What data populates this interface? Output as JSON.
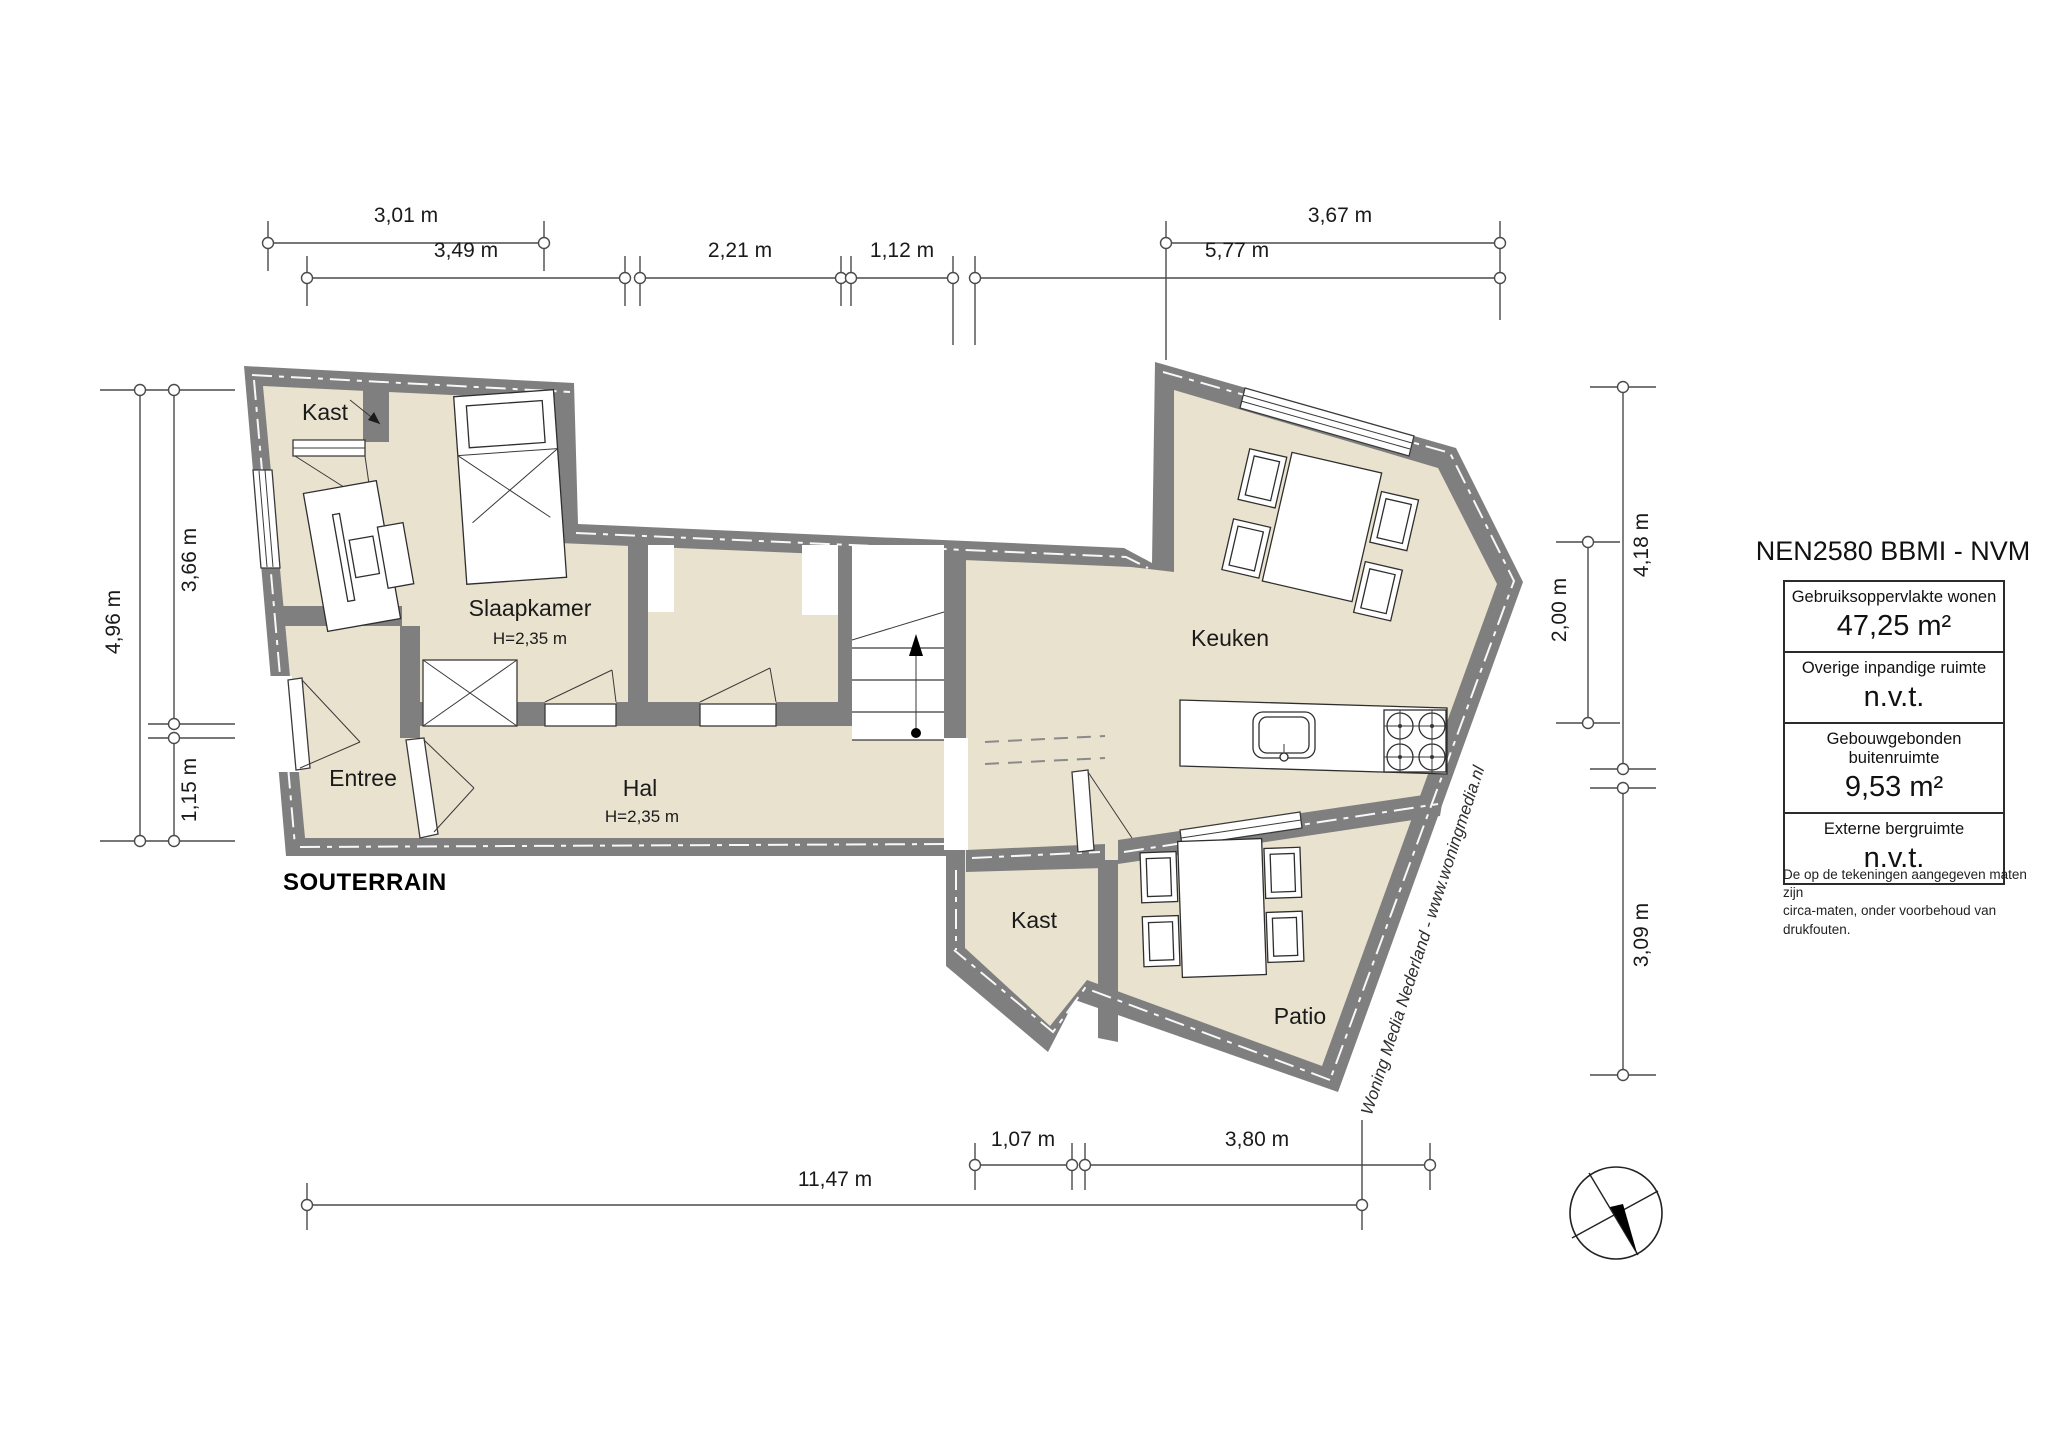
{
  "colors": {
    "wall": "#7f7f7f",
    "floor": "#e9e2cf",
    "ink": "#1a1a1a",
    "dim": "#4a4a4a",
    "paper": "#ffffff"
  },
  "floor_label": "SOUTERRAIN",
  "rooms": {
    "kast_top": {
      "label": "Kast"
    },
    "slaapkamer": {
      "label": "Slaapkamer",
      "height": "H=2,35 m"
    },
    "entree": {
      "label": "Entree"
    },
    "hal": {
      "label": "Hal",
      "height": "H=2,35 m"
    },
    "keuken": {
      "label": "Keuken"
    },
    "kast_bottom": {
      "label": "Kast"
    },
    "patio": {
      "label": "Patio"
    }
  },
  "dimensions": {
    "top_row1": [
      "3,01 m",
      "3,67 m"
    ],
    "top_row2": [
      "3,49 m",
      "2,21 m",
      "1,12 m",
      "5,77 m"
    ],
    "left": [
      "4,96 m",
      "3,66 m",
      "1,15 m"
    ],
    "right": [
      "4,18 m",
      "2,00 m",
      "3,09 m"
    ],
    "bottom_row1": [
      "1,07 m",
      "3,80 m"
    ],
    "bottom_row2": [
      "11,47 m"
    ]
  },
  "legend_table": {
    "title": "NEN2580 BBMI - NVM",
    "rows": [
      {
        "label": "Gebruiksoppervlakte wonen",
        "value": "47,25 m²"
      },
      {
        "label": "Overige inpandige ruimte",
        "value": "n.v.t."
      },
      {
        "label": "Gebouwgebonden buitenruimte",
        "value": "9,53 m²"
      },
      {
        "label": "Externe bergruimte",
        "value": "n.v.t."
      }
    ],
    "disclaimer_line1": "De op de tekeningen aangegeven maten zijn",
    "disclaimer_line2": "circa-maten, onder voorbehoud van drukfouten."
  },
  "watermark": "Woning Media Nederland - www.woningmedia.nl",
  "icons": {
    "compass": "compass-rose",
    "stairs_direction": "up-arrow"
  }
}
